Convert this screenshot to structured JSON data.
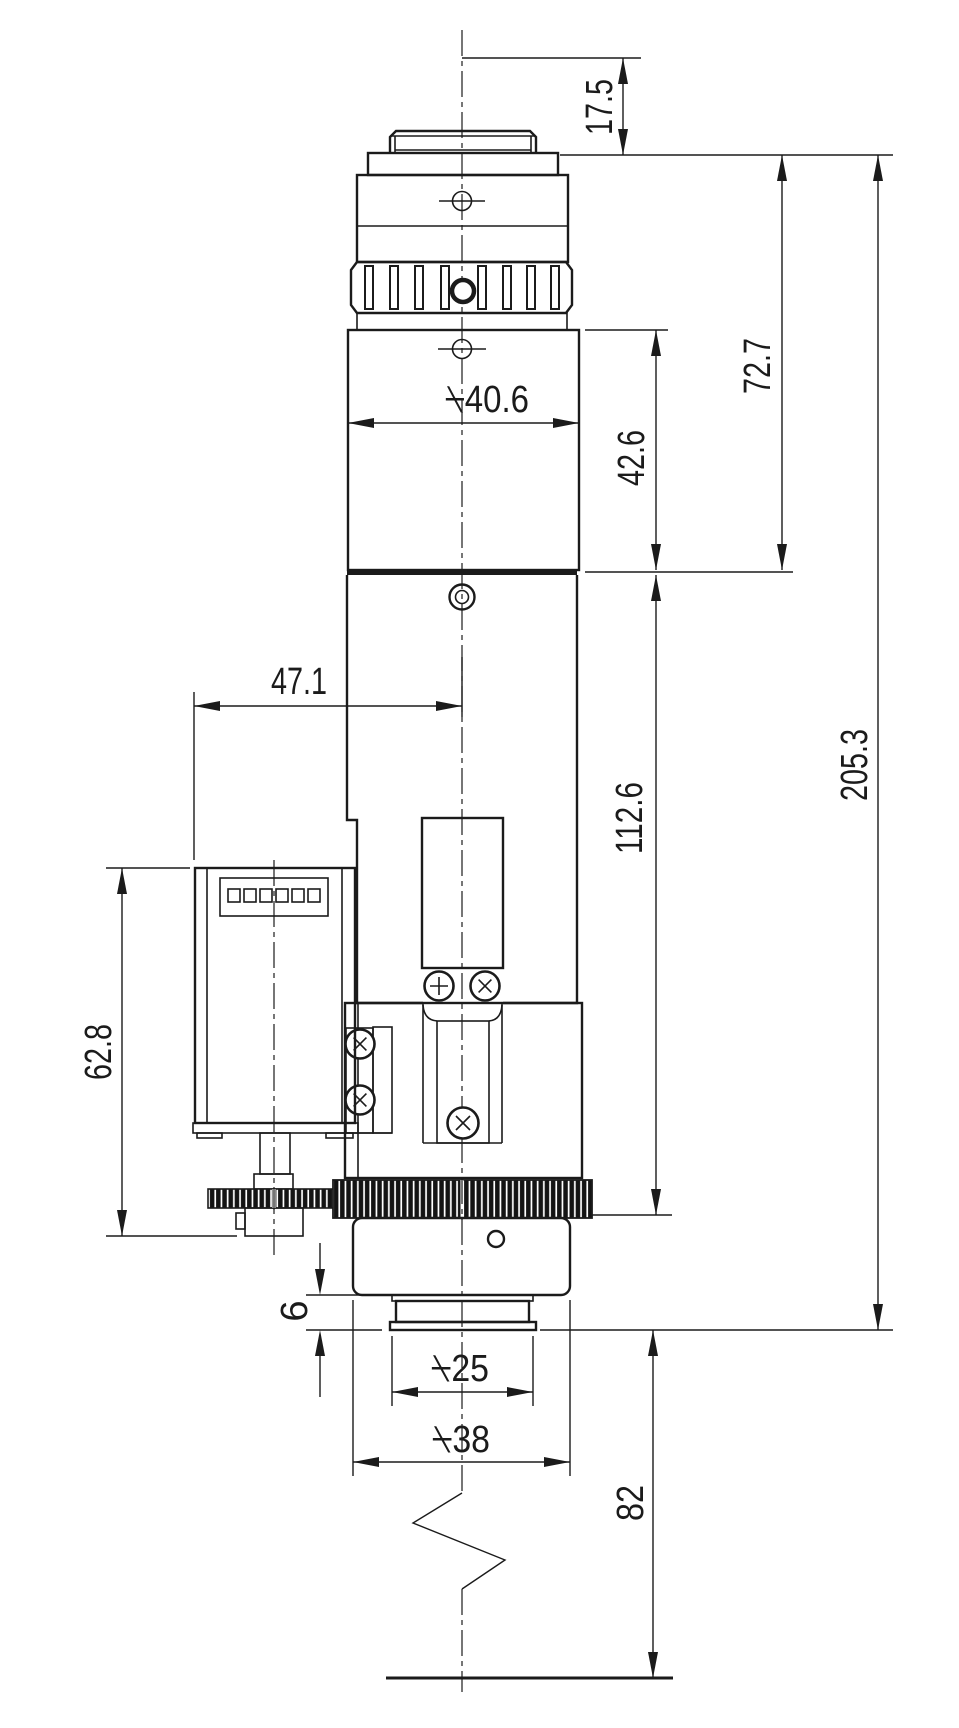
{
  "dims": {
    "flange_focal": "17.5",
    "upper_assembly": "72.7",
    "tube_len": "42.6",
    "tube_dia": "⍀40.6",
    "motor_offset": "47.1",
    "body_len": "112.6",
    "motor_len": "62.8",
    "overall": "205.3",
    "tip_len": "6",
    "tip_dia": "⍀25",
    "nose_dia": "⍀38",
    "working_dist": "82"
  }
}
